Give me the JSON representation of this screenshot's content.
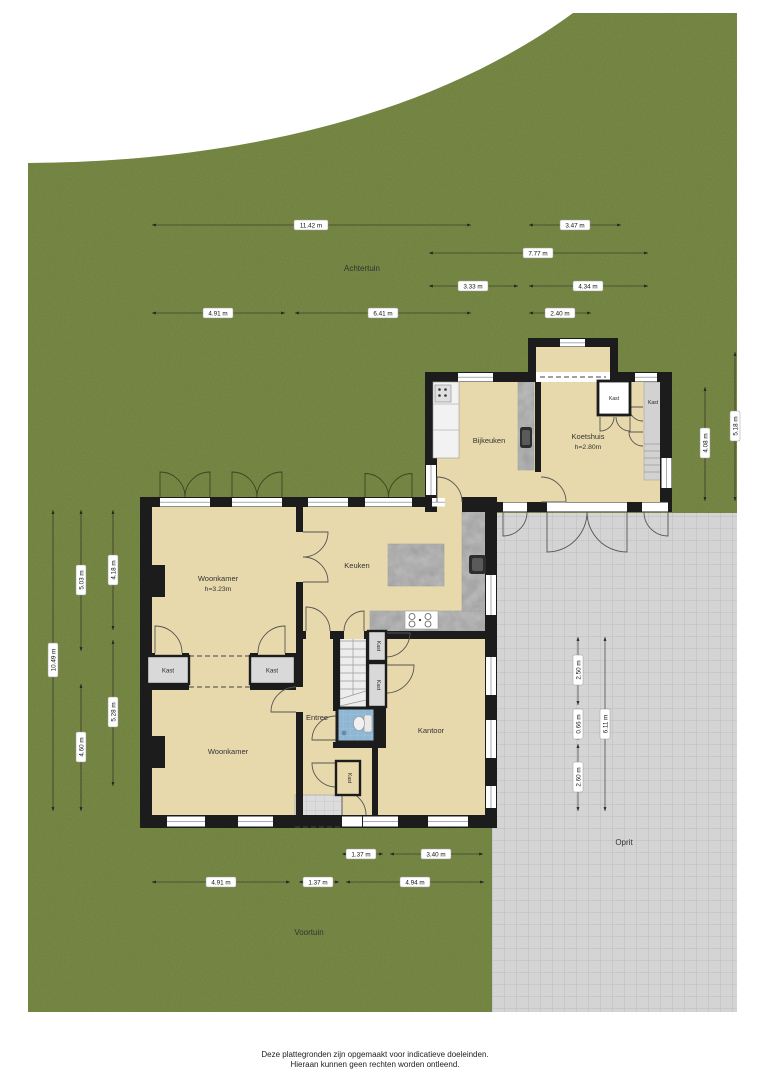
{
  "colors": {
    "grass": "#7d8c4c",
    "floor": "#e8d9ac",
    "wall": "#1c1c1c",
    "paving": "#d4d4d4",
    "closet": "#d9d9d9",
    "counter": "#9e9e9e",
    "stairs": "#ededed",
    "toilet": "#8fb7d4",
    "dim": "#222222",
    "text": "#333333"
  },
  "garden": {
    "achtertuin": "Achtertuin",
    "voortuin": "Voortuin",
    "oprit": "Oprit"
  },
  "rooms": {
    "woonkamer1": {
      "name": "Woonkamer",
      "height": "h=3.23m"
    },
    "keuken": "Keuken",
    "bijkeuken": "Bijkeuken",
    "koetshuis": {
      "name": "Koetshuis",
      "height": "h=2.80m"
    },
    "woonkamer2": "Woonkamer",
    "entree": "Entree",
    "kantoor": "Kantoor",
    "kast": "Kast"
  },
  "dims": {
    "t1": "11.42 m",
    "t2": "3.47 m",
    "t3": "7.77 m",
    "t4": "3.33 m",
    "t5": "4.34 m",
    "t6": "4.91 m",
    "t7": "6.41 m",
    "t8": "2.40 m",
    "l1": "10.49 m",
    "l2": "5.03 m",
    "l3": "4.60 m",
    "l4": "4.18 m",
    "l5": "5.28 m",
    "r1": "4.08 m",
    "r2": "5.18 m",
    "o1": "2.50 m",
    "o2": "0.66 m",
    "o3": "2.60 m",
    "o4": "6.11 m",
    "b1": "1.37 m",
    "b2": "3.40 m",
    "b3": "4.91 m",
    "b4": "1.37 m",
    "b5": "4.94 m"
  },
  "footer": {
    "line1": "Deze plattegronden zijn opgemaakt voor indicatieve doeleinden.",
    "line2": "Hieraan kunnen geen rechten worden ontleend."
  }
}
